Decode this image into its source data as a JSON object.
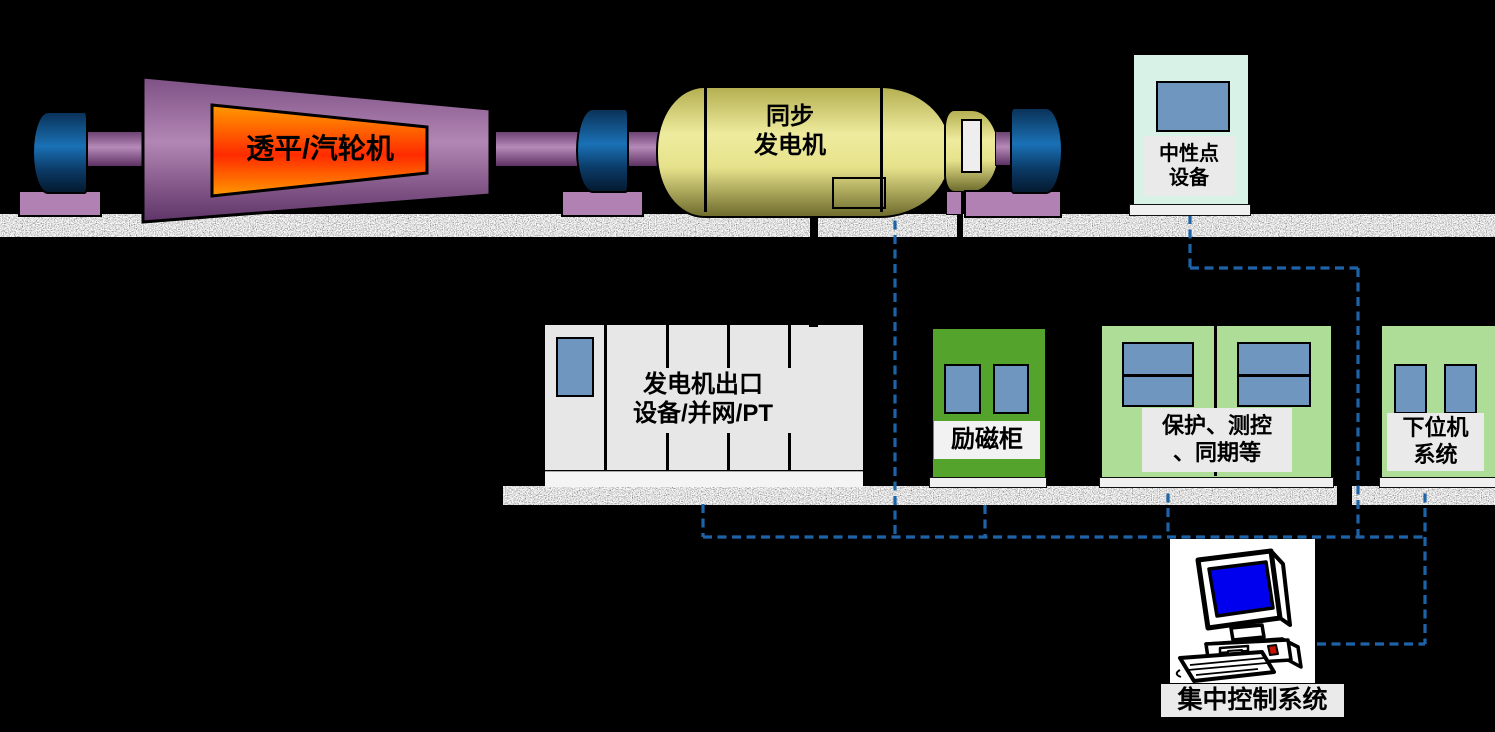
{
  "turbine": {
    "label": "透平/汽轮机"
  },
  "generator": {
    "label": "同步\n发电机"
  },
  "neutral_point": {
    "label": "中性点\n设备"
  },
  "outlet_cabinet": {
    "label": "发电机出口\n设备/并网/PT"
  },
  "excitation_cabinet": {
    "label": "励磁柜"
  },
  "protection_cabinet": {
    "label": "保护、测控\n、同期等"
  },
  "lower_computer": {
    "label": "下位机\n系统"
  },
  "central_control": {
    "label": "集中控制系统"
  },
  "icons": {
    "computer": "desktop-computer-icon",
    "screens": "cabinet-screen"
  },
  "palette": {
    "bg": "#000000",
    "dash_blue": "#1d63a8",
    "screen_blue": "#6e96bf",
    "crt_blue": "#0000ee",
    "mint": "#d9f2e8",
    "cabinet_gray": "#e7e7e7",
    "label_gray": "#eaeaea",
    "green": "#54a32c",
    "green_light": "#aedd97",
    "purple_light": "#b181b3",
    "bearing_blue": "#1a71b6",
    "body_yellow": "#e9e58c",
    "flame_orange": "#ff9a00",
    "flame_red": "#ff2b00",
    "switch_red": "#cc1100",
    "base_white": "#f0f0f0"
  }
}
